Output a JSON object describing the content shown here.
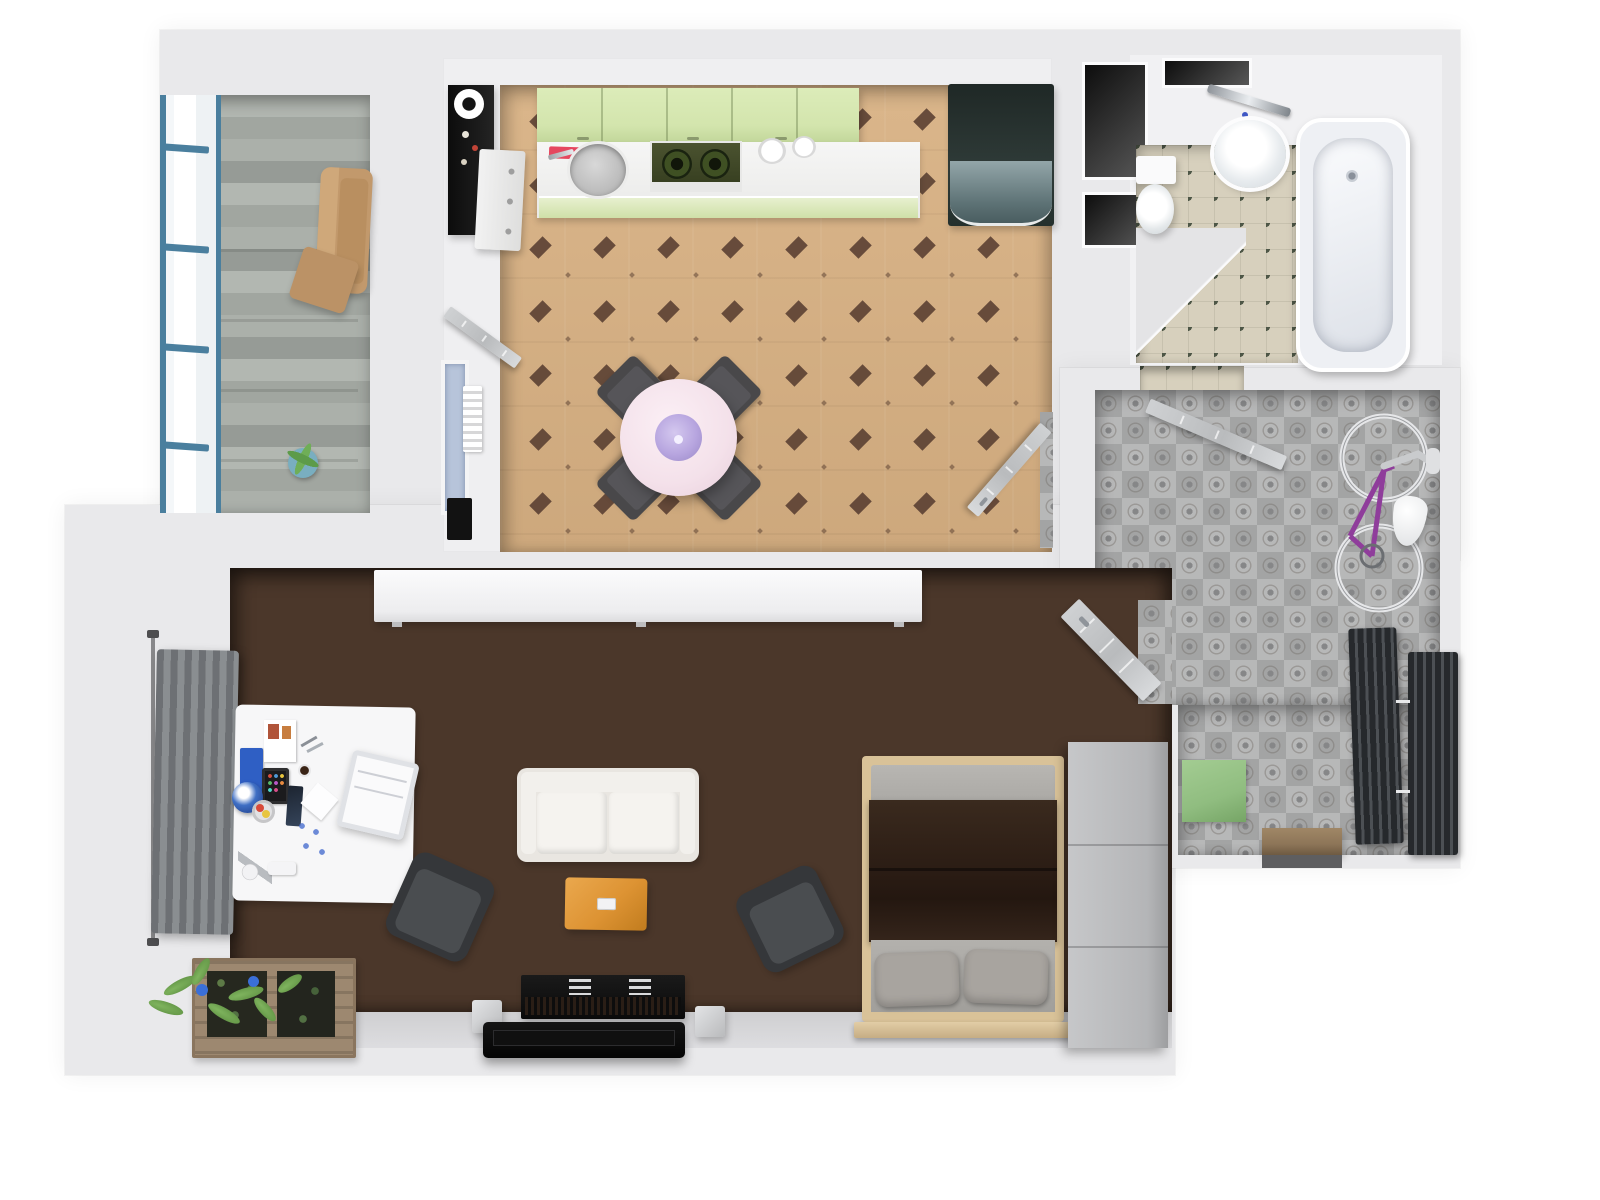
{
  "title": "3D top-down apartment floor plan render",
  "colors": {
    "page_bg": "#ffffff",
    "wall": "#e9e9eb",
    "window_blue": "#4a7f9e",
    "kitchen_floor": "#d8b183",
    "kitchen_diamond": "#53392e",
    "cabinet_green": "#d3e5ad",
    "table_pink": "#f4e1ea",
    "lamp_purple": "#b7a5df",
    "chair_dark": "#49484a",
    "bath_floor": "#d7d0bd",
    "bath_dot": "#4e5747",
    "hall_tile": "#b0b2b4",
    "bike_purple": "#8f3d9b",
    "mat_green": "#90bd80",
    "threshold_brown": "#8d7558",
    "coffee_table_orange": "#dd9333",
    "blanket_brown": "#2e1f16",
    "bed_frame_tan": "#d9c298",
    "crate_wood": "#9d8870"
  },
  "patterns": {
    "kitchen_diamond": {
      "spacing": 64,
      "big_w": 13,
      "big_h": 13,
      "small_w": 4
    }
  },
  "rooms": [
    {
      "name": "balcony",
      "floor": "weathered-gray-wood-planks",
      "furniture": [
        "blue-framed-window-wall",
        "tan-armchair",
        "tan-ottoman",
        "potted-plant"
      ]
    },
    {
      "name": "kitchen",
      "floor": "tan-tile-with-dark-diamond-pattern",
      "furniture": [
        "green-upper-cabinets",
        "white-countertop",
        "round-sink",
        "red-cutting-board",
        "gas-stove",
        "two-plates",
        "black-refrigerator-with-glass-front",
        "black-bar-shelf-with-kettle",
        "white-drawer-cabinet",
        "round-pink-dining-table-with-purple-lamp",
        "four-dark-dining-chairs",
        "window",
        "white-radiator",
        "black-bin",
        "open-door-west",
        "open-door-southeast-to-hallway"
      ]
    },
    {
      "name": "bathroom",
      "floor": "beige-tile-with-olive-dots",
      "furniture": [
        "bathtub",
        "corner-sink",
        "chrome-faucet",
        "toilet",
        "dark-utility-niches"
      ]
    },
    {
      "name": "hallway",
      "floor": "gray-ornamental-tile",
      "furniture": [
        "wall-mounted-purple-bicycle",
        "white-bag",
        "two-dark-radiators",
        "green-doormat",
        "entry-threshold",
        "open-door-to-bathroom"
      ]
    },
    {
      "name": "living-room",
      "floor": "dark-wood-parquet",
      "furniture": [
        "white-sideboard",
        "gray-curtain-with-rod",
        "white-desk-with-accessories",
        "translucent-desk-chair",
        "white-two-seat-sofa",
        "orange-coffee-table",
        "two-dark-armchairs",
        "black-tv-console",
        "black-tv-panel",
        "two-silver-speakers",
        "double-bed-brown-blanket-gray-pillows",
        "gray-wardrobe",
        "wooden-planter-crate-with-plants",
        "open-door-to-hallway"
      ]
    }
  ]
}
